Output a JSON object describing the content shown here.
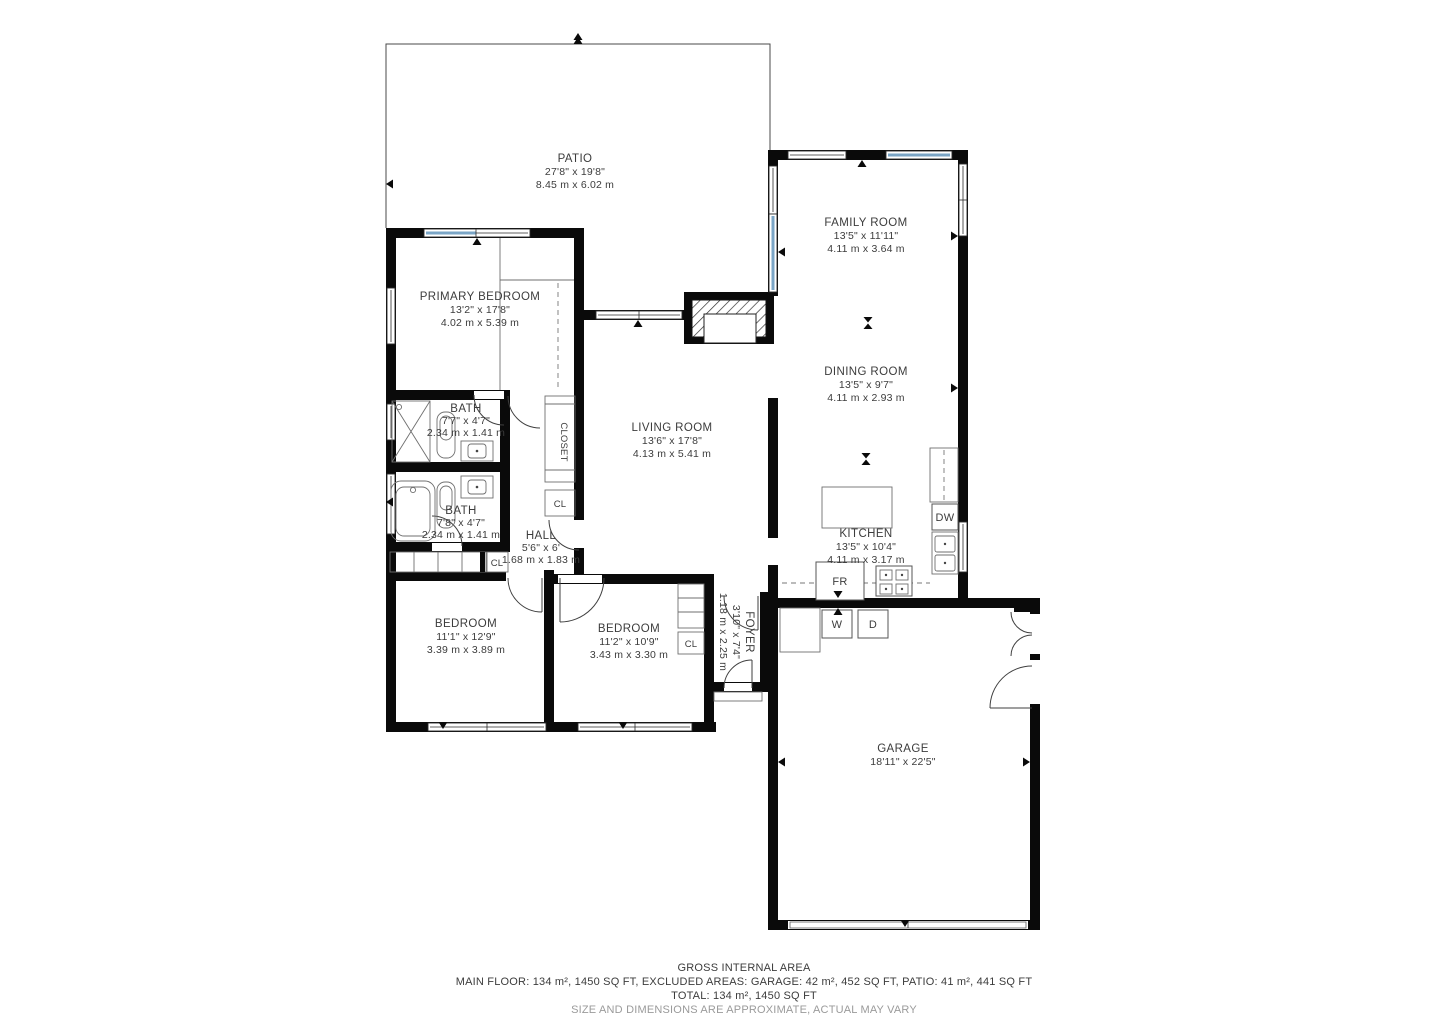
{
  "colors": {
    "wall": "#0a0a0a",
    "glass": "#7aa5c6",
    "line": "#4a4a4a",
    "text": "#3c3c3c",
    "muted": "#9a9a9a"
  },
  "rooms": [
    {
      "name": "PATIO",
      "dim_ft": "27'8\" x 19'8\"",
      "dim_m": "8.45 m x 6.02 m"
    },
    {
      "name": "FAMILY ROOM",
      "dim_ft": "13'5\" x 11'11\"",
      "dim_m": "4.11 m x 3.64 m"
    },
    {
      "name": "PRIMARY BEDROOM",
      "dim_ft": "13'2\" x 17'8\"",
      "dim_m": "4.02 m x 5.39 m"
    },
    {
      "name": "DINING ROOM",
      "dim_ft": "13'5\" x 9'7\"",
      "dim_m": "4.11 m x 2.93 m"
    },
    {
      "name": "LIVING ROOM",
      "dim_ft": "13'6\" x 17'8\"",
      "dim_m": "4.13 m x 5.41 m"
    },
    {
      "name": "BATH",
      "dim_ft": "7'7\" x 4'7\"",
      "dim_m": "2.34 m x 1.41 m"
    },
    {
      "name": "BATH",
      "dim_ft": "7'8\" x 4'7\"",
      "dim_m": "2.34 m x 1.41 m"
    },
    {
      "name": "HALL",
      "dim_ft": "5'6\" x 6'",
      "dim_m": "1.68 m x 1.83 m"
    },
    {
      "name": "KITCHEN",
      "dim_ft": "13'5\" x 10'4\"",
      "dim_m": "4.11 m x 3.17 m"
    },
    {
      "name": "BEDROOM",
      "dim_ft": "11'1\" x 12'9\"",
      "dim_m": "3.39 m x 3.89 m"
    },
    {
      "name": "BEDROOM",
      "dim_ft": "11'2\" x 10'9\"",
      "dim_m": "3.43 m x 3.30 m"
    },
    {
      "name": "FOYER",
      "dim_ft": "3'10\" x 7'4\"",
      "dim_m": "1.18 m x 2.25 m"
    },
    {
      "name": "GARAGE",
      "dim_ft": "18'11\" x 22'5\""
    }
  ],
  "labels": {
    "closet": "CLOSET",
    "cl": "CL",
    "dw": "DW",
    "fr": "FR",
    "washer": "W",
    "dryer": "D"
  },
  "footer": {
    "line1": "GROSS INTERNAL AREA",
    "line2": "MAIN FLOOR: 134 m², 1450 SQ FT, EXCLUDED AREAS: GARAGE: 42 m², 452 SQ FT, PATIO: 41 m², 441 SQ FT",
    "line3": "TOTAL: 134 m², 1450 SQ FT",
    "line4": "SIZE AND DIMENSIONS ARE APPROXIMATE, ACTUAL MAY VARY"
  }
}
